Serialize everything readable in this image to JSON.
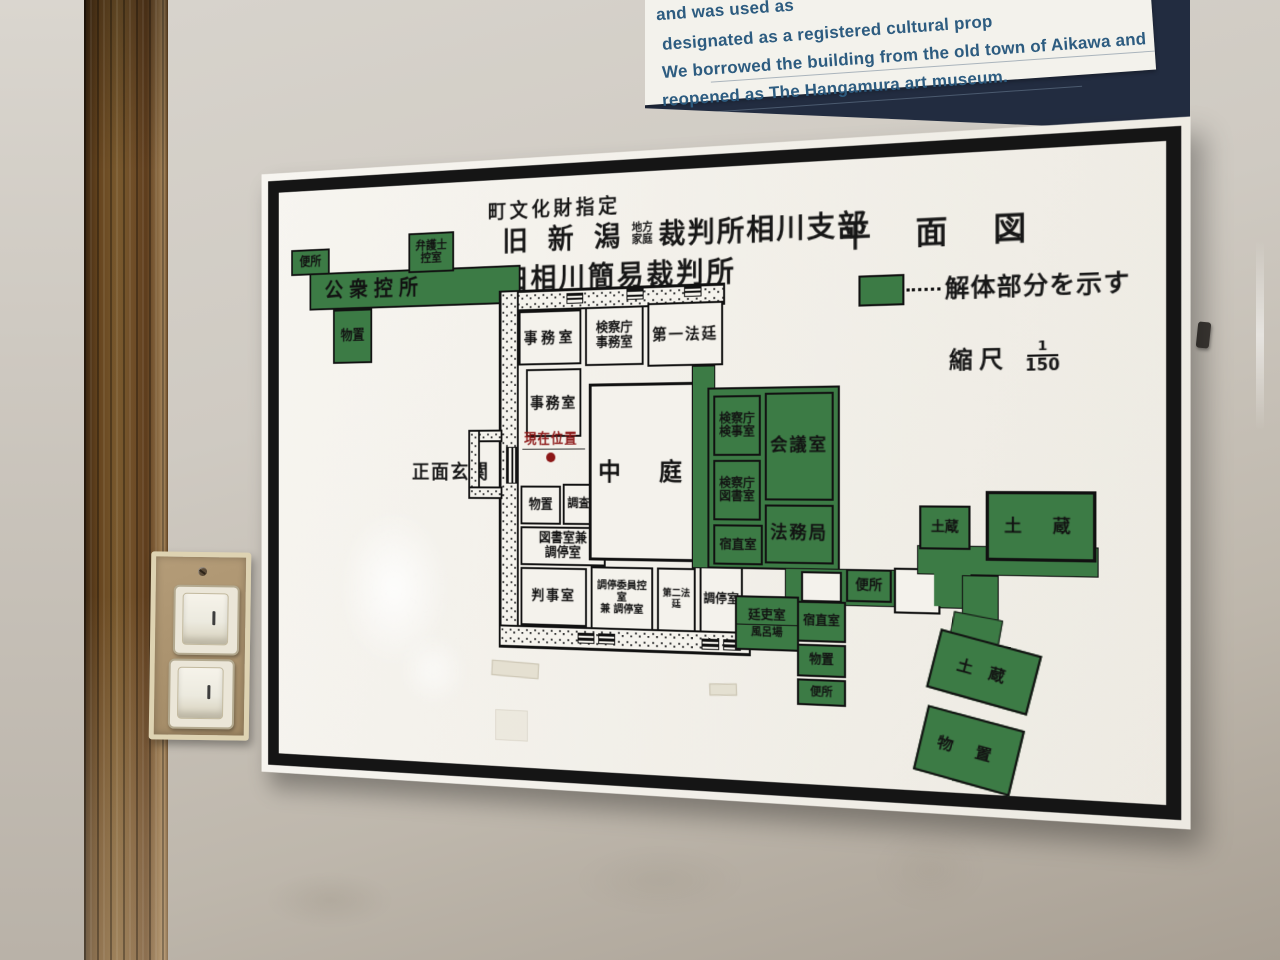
{
  "sign": {
    "lines": [
      "and was used as",
      "designated as a registered cultural prop",
      "We borrowed the building from the old town of Aikawa and",
      "reopened as The Hangamura art museum."
    ]
  },
  "plan": {
    "title": {
      "designation": "町文化財指定",
      "line2_prefix": "旧 新 潟",
      "line2_small_top": "地方",
      "line2_small_bottom": "家庭",
      "line2_suffix": "裁判所相川支部",
      "line3": "旧相川簡易裁判所",
      "map_type": "平 面 図"
    },
    "legend": {
      "text": "解体部分を示す",
      "scale_label": "縮尺",
      "scale_numerator": "1",
      "scale_denominator": "150",
      "demolished_color": "#3c7b45"
    },
    "markers": {
      "current_location": "現在位置",
      "main_entrance": "正面玄関",
      "courtyard": "中　庭"
    },
    "rooms": {
      "bensho_nw": "便所",
      "koshu_hikaesho": "公衆控所",
      "bengoshi_hikaeshitsu": "弁護士\n控室",
      "monooki_nw": "物置",
      "jimushitsu_1": "事務室",
      "kensatsucho_jimushitsu": "検察庁\n事務室",
      "dai1_hotei": "第一法廷",
      "jimushitsu_2": "事務室",
      "monooki_inner": "物置",
      "chosashitsu": "調査室",
      "tosho_chotei": "図書室兼\n調停室",
      "kenjishitsu": "検察庁\n検事室",
      "kensatsu_tosho": "検察庁\n図書室",
      "kaigishitsu": "会議室",
      "homukyoku": "法務局",
      "shukuchokushitsu_1": "宿直室",
      "hanjishitsu": "判事室",
      "chotei_iin_hikae": "調停委員控室\n兼 調停室",
      "dai2_hotei": "第二法廷",
      "choteishitsu": "調停室",
      "teirishitsu": "廷吏室",
      "furoba": "風呂場",
      "bensho_mid": "便所",
      "shukuchokushitsu_2": "宿直室",
      "monooki_2": "物置",
      "bensho_low": "便所",
      "dozo_small": "土蔵",
      "dozo_large": "土　蔵",
      "dozo_rotated": "土 蔵",
      "monooki_rotated": "物 置"
    }
  }
}
